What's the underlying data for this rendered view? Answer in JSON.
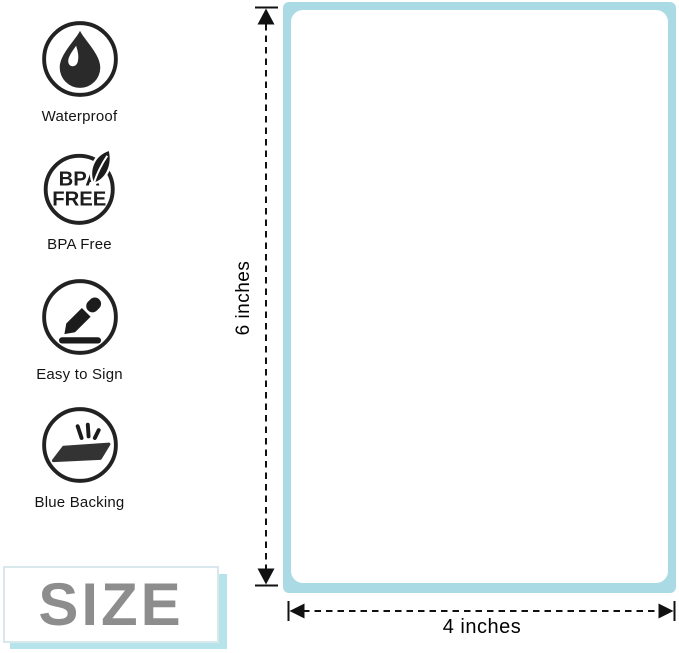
{
  "features": {
    "items": [
      {
        "icon": "water-drop-icon",
        "label": "Waterproof"
      },
      {
        "icon": "bpa-free-badge-icon",
        "label": "BPA Free",
        "badge_line1": "BPA",
        "badge_line2": "FREE"
      },
      {
        "icon": "pencil-sign-icon",
        "label": "Easy to Sign"
      },
      {
        "icon": "label-sheet-icon",
        "label": "Blue Backing"
      }
    ]
  },
  "size_badge": {
    "label": "SIZE"
  },
  "label_diagram": {
    "height_label": "6 inches",
    "width_label": "4 inches"
  },
  "colors": {
    "backing_blue": "#aadbe5",
    "size_shadow_blue": "#b7e3ea",
    "size_text_gray": "#8d8d8d",
    "icon_black": "#222222",
    "arrow_black": "#111111"
  }
}
